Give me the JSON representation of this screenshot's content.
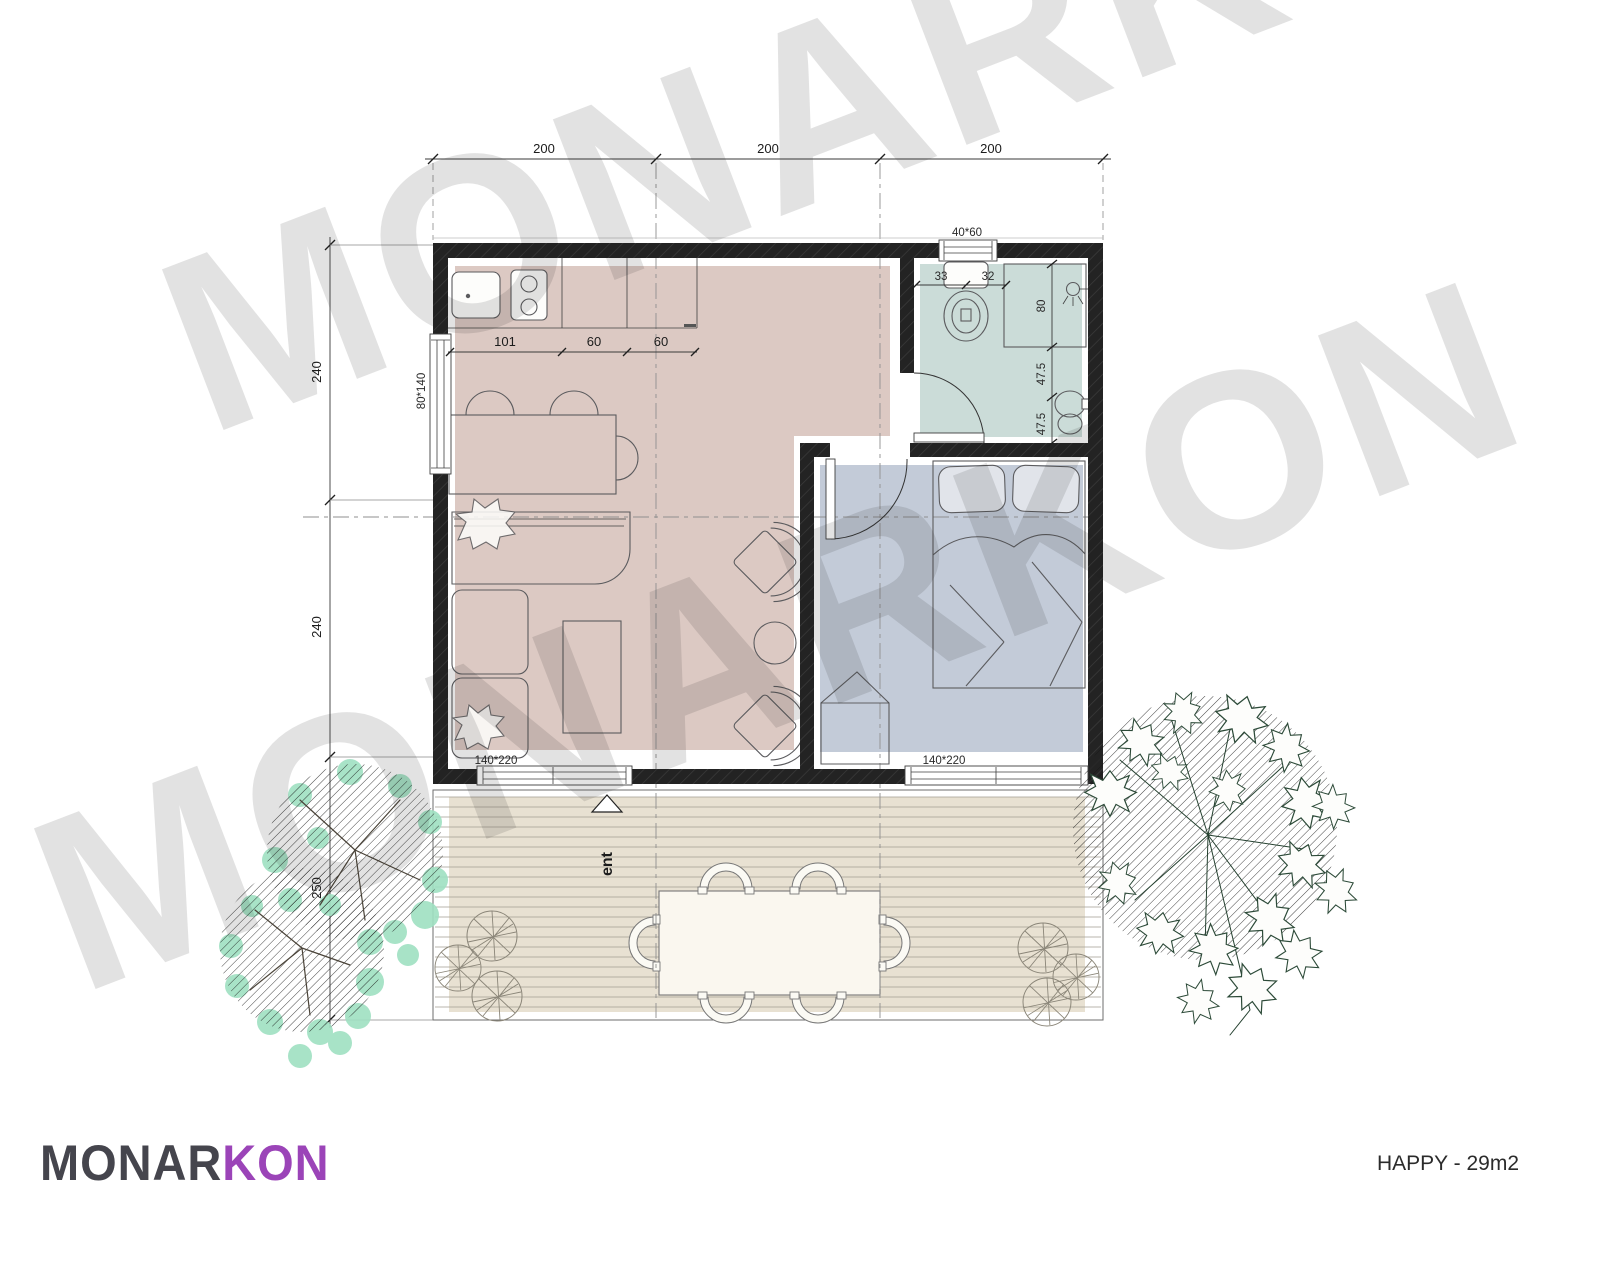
{
  "branding": {
    "logo_primary": "MONAR",
    "logo_accent": "KON",
    "plan_title": "HAPPY - 29m2",
    "watermark": "MONARKON"
  },
  "entrance_label": "ent",
  "dimensions": {
    "top": [
      "200",
      "200",
      "200"
    ],
    "left": [
      "240",
      "240",
      "250"
    ],
    "kitchen": [
      "101",
      "60",
      "60"
    ],
    "toilet": [
      "33",
      "32"
    ],
    "shower_width": "80",
    "sink": [
      "47.5",
      "47.5"
    ]
  },
  "openings": {
    "bath_window": "40*60",
    "side_window": "80*140",
    "living_door": "140*220",
    "bedroom_window": "140*220"
  },
  "colors": {
    "living": "#dcc9c3",
    "bedroom": "#c3cbd8",
    "bathroom": "#cbdcd8",
    "deck": "#e8e1d2",
    "wall": "#232323",
    "tree_foliage": "#9fe0c2",
    "logo_primary": "#45454d",
    "logo_accent": "#9b44b8"
  }
}
